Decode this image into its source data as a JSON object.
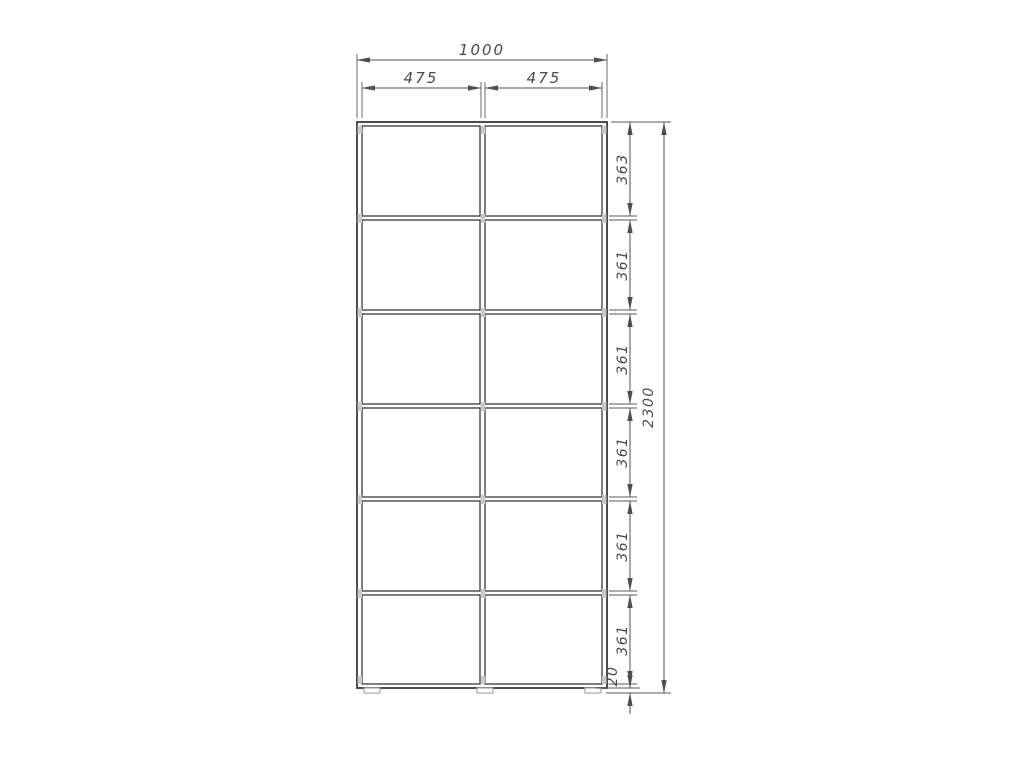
{
  "drawing": {
    "overall_width": "1000",
    "overall_height": "2300",
    "column_widths": [
      "475",
      "475"
    ],
    "row_heights": [
      "363",
      "361",
      "361",
      "361",
      "361",
      "361"
    ],
    "plinth_height": "20",
    "grid": {
      "columns": 2,
      "rows": 6
    },
    "colors": {
      "line": "#383838",
      "dimension": "#4f4f4f",
      "fitting": "#c9c9c9",
      "background": "#ffffff"
    }
  }
}
